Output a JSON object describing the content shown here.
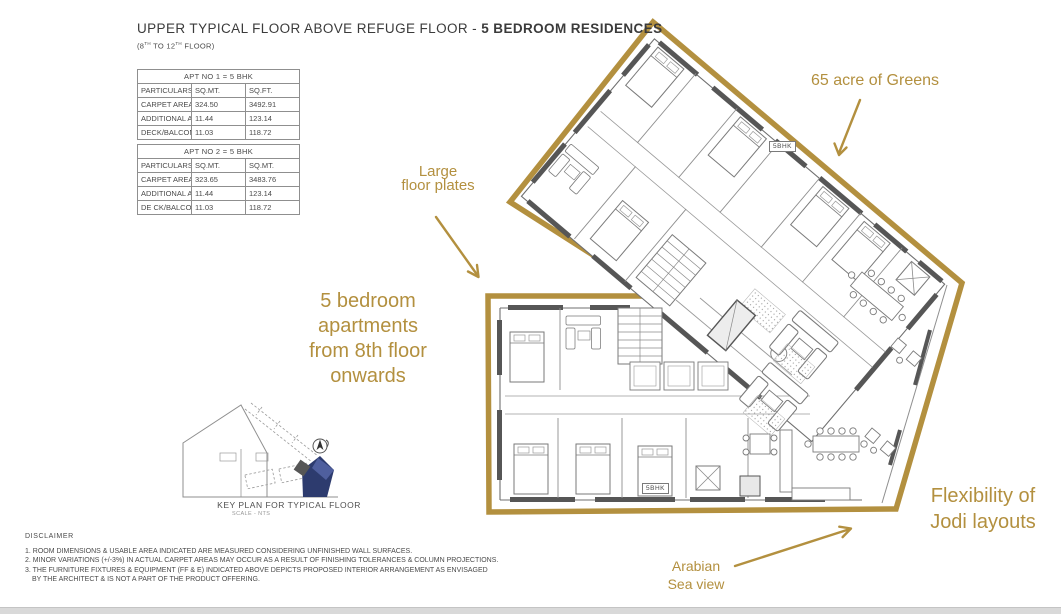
{
  "header": {
    "title_main": "UPPER TYPICAL FLOOR ABOVE REFUGE FLOOR - ",
    "title_bold": "5 BEDROOM RESIDENCES",
    "subtitle": {
      "p1": "(8",
      "sup1": "TH",
      "p2": " TO 12",
      "sup2": "TH",
      "p3": " FLOOR)"
    }
  },
  "area_tables": [
    {
      "title": "APT NO 1 = 5 BHK",
      "headers": [
        "PARTICULARS (AS PER RERA)",
        "SQ.MT.",
        "SQ.FT."
      ],
      "rows": [
        [
          "CARPET AREA",
          "324.50",
          "3492.91"
        ],
        [
          "ADDITIONAL AREA",
          "11.44",
          "123.14"
        ],
        [
          "DECK/BALCONY AREA",
          "11.03",
          "118.72"
        ]
      ]
    },
    {
      "title": "APT NO 2 = 5 BHK",
      "headers": [
        "PARTICULARS (AS PER RERA)",
        "SQ.MT.",
        "SQ.MT."
      ],
      "rows": [
        [
          "CARPET AREA",
          "323.65",
          "3483.76"
        ],
        [
          "ADDITIONAL AREA",
          "11.44",
          "123.14"
        ],
        [
          "DE CK/BALCONY AREA",
          "11.03",
          "118.72"
        ]
      ]
    }
  ],
  "annotations": {
    "greens": "65 acre of Greens",
    "large_plates": {
      "line1": "Large",
      "line2": "floor plates"
    },
    "five_bedroom": {
      "line1": "5 bedroom",
      "line2": "apartments",
      "line3": "from 8th floor",
      "line4": "onwards"
    },
    "flexibility": {
      "line1": "Flexibility of",
      "line2": "Jodi layouts"
    },
    "arabian": {
      "line1": "Arabian",
      "line2": "Sea view"
    }
  },
  "plan": {
    "unit_label_upper": "5BHK",
    "unit_label_lower": "5BHK"
  },
  "key_plan": {
    "title": "KEY PLAN FOR  TYPICAL FLOOR",
    "scale_note": "SCALE - NTS"
  },
  "disclaimer": {
    "title": "DISCLAIMER",
    "lines": [
      "1. ROOM DIMENSIONS & USABLE AREA INDICATED ARE MEASURED CONSIDERING UNFINISHED WALL SURFACES.",
      "2. MINOR VARIATIONS (+/-3%) IN ACTUAL CARPET AREAS MAY OCCUR AS A RESULT OF FINISHING TOLERANCES & COLUMN PROJECTIONS.",
      "3. THE FURNITURE FIXTURES & EQUIPMENT (FF & E) INDICATED ABOVE DEPICTS PROPOSED INTERIOR ARRANGEMENT AS ENVISAGED",
      "BY THE ARCHITECT & IS NOT A PART OF THE PRODUCT OFFERING."
    ]
  },
  "colors": {
    "accent_gold": "#B3903F",
    "wall_dark": "#565656",
    "line_gray": "#8f8f8f",
    "keyplan_blue_dark": "#2d3b6e",
    "keyplan_blue_light": "#4f5f9e"
  }
}
